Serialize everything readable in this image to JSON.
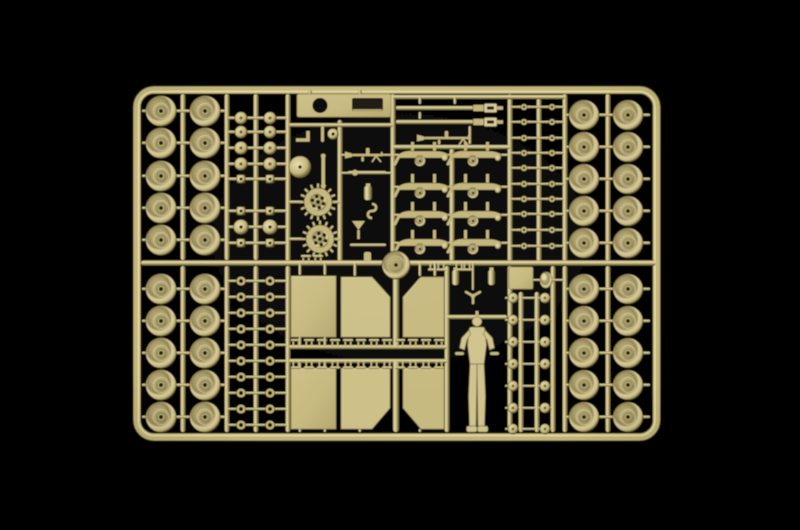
{
  "scene": {
    "description": "Tan plastic injection-molded model kit sprue with military tank parts photographed on a black background",
    "canvas": {
      "width": 800,
      "height": 530
    },
    "background_color": "#000000",
    "palette": {
      "base": "#c2b478",
      "light": "#e9dfad",
      "bright": "#f0e6bb",
      "shadow": "#7a6d44",
      "deep": "#4a421f",
      "panel": "#c6b97e",
      "panel_alt": "#ccbf86",
      "wheel_rim": "#d9cd9b",
      "wheel_face": "#a89b67",
      "wheel_hub": "#ab9e6a",
      "hole": "#171206",
      "figure": "#cfc28c",
      "edge_dark": "#3a3218"
    }
  },
  "parts_inventory": {
    "road_wheels": 40,
    "suspension_bogies": 8,
    "drive_sprockets": 2,
    "idler_wheel": 1,
    "spare_wheel_disc": 1,
    "gun_barrels": 2,
    "machine_guns": 2,
    "hull_top_plate": 1,
    "small_hatch_plate": 1,
    "fender_panels": 6,
    "track_clamp_fittings": 26,
    "crew_figure": 1,
    "helmet": 1,
    "propeller_fitting": 1,
    "stowage_cylinders": 2,
    "small_rings": 20,
    "dumbbell_fittings": 20,
    "mixed_round_square_fittings": 16,
    "round_knob_fittings": 14,
    "tool_parts": 7
  }
}
